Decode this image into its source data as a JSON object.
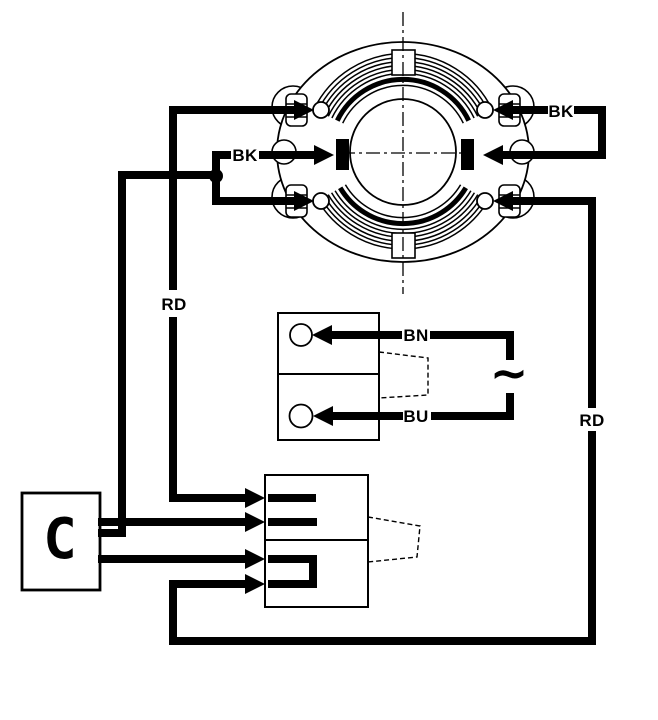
{
  "colors": {
    "ink": "#000000",
    "paper": "#ffffff"
  },
  "diagram": {
    "wire_labels": {
      "bk_left": "BK",
      "bk_right": "BK",
      "rd_left": "RD",
      "rd_right": "RD",
      "bn": "BN",
      "bu": "BU"
    },
    "symbols": {
      "ac": "~",
      "capacitor": "C"
    }
  }
}
